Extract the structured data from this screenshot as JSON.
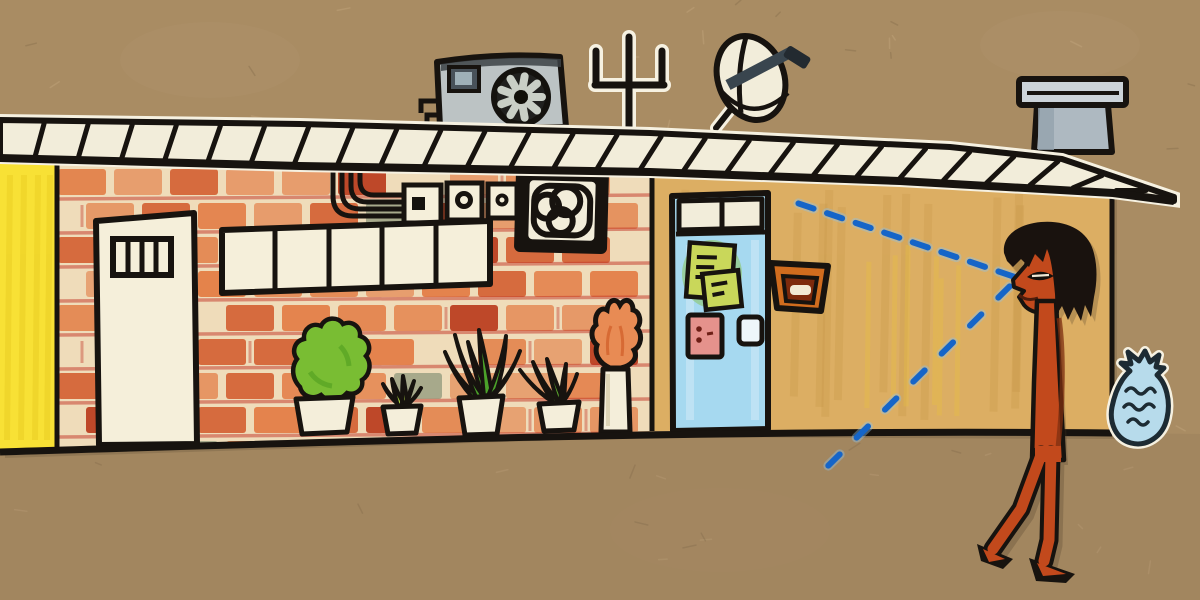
{
  "meta": {
    "title": "Hand-drawn building illustration on kraft paper",
    "medium": "marker and crayon collage"
  },
  "palette": {
    "kraft": "#a98c63",
    "kraftDark": "#856c4e",
    "outline": "#17130f",
    "roofWhite": "#f2edda",
    "stickerWhite": "#f6f1e1",
    "shadow": "#4a3a26",
    "yellowWall": "#f8e135",
    "yellowStreak": "#e6c81e",
    "brickBase": "#efdcba",
    "brickOrange": "#e06a2e",
    "brickDeep": "#cf4f1f",
    "brickRed": "#b8371a",
    "brickGray": "#9aa083",
    "mortarRed": "#c23527",
    "doorWhite": "#f5efda",
    "acGray": "#bcc3c4",
    "acDark": "#3c4245",
    "fanBlade": "#c9cfc6",
    "chimneyGray": "#aeb9c1",
    "chimneyCap": "#ccd3d8",
    "dishBand": "#39454e",
    "tanWall": "#dcae63",
    "tanStreak": "#c49343",
    "tanYellow": "#e6bd45",
    "doorBlue": "#a6d9f0",
    "blueStreak": "#d6ecf8",
    "noteGreen": "#c9d75a",
    "noteGlow": "#86c03c",
    "switchPink": "#e5928c",
    "switchDots": "#6e1f16",
    "mailOrange": "#d06c1e",
    "mailInner": "#7e2a0c",
    "potWhite": "#f4eeda",
    "bushGreen": "#79bd33",
    "bushDark": "#55a322",
    "spikyGreen": "#4ba32a",
    "spikyLight": "#a5cc3d",
    "spikyMid": "#5eae2f",
    "flameOrange": "#e88b54",
    "flameDark": "#d2622c",
    "skin": "#c2491c",
    "skinDark": "#7e2f10",
    "hairBlack": "#19120e",
    "bagBlue": "#b7dbeb",
    "bagLine": "#1d2b33",
    "dashBlue": "#1565c8",
    "dashHalo": "#8fc2e8"
  },
  "scene": {
    "background": {
      "label": "kraft paper",
      "speckles": 70
    },
    "roof": {
      "label": "white roof band with hatched shingles",
      "hatch_count": 26
    },
    "rooftop_equipment": {
      "ac_unit": {
        "label": "air conditioner with round fan",
        "blades": 9
      },
      "antenna": {
        "label": "three-prong tv antenna"
      },
      "satellite_dish": {
        "label": "tilted satellite dish"
      },
      "chimney": {
        "label": "grey chimney vent"
      }
    },
    "walls": {
      "yellow_section": {
        "label": "yellow wall strip (far left)"
      },
      "brick_section": {
        "label": "orange crayon brick wall",
        "rows": 9,
        "left": 58,
        "right": 650,
        "top": 169,
        "row_height": 34,
        "brick_width": 48,
        "gap": 8
      },
      "tan_section": {
        "label": "tan stucco wall"
      }
    },
    "openings": {
      "white_door": {
        "label": "white door with small barred window",
        "bars": 3
      },
      "window_band": {
        "label": "horizontal strip window",
        "panes": 5
      },
      "blue_door": {
        "label": "blue door with two-pane transom",
        "sticky_notes": 2
      }
    },
    "fixtures": {
      "conduit": {
        "label": "curved conduit pipes",
        "lines": 4
      },
      "electrical_boxes": {
        "label": "meter boxes",
        "count": 3
      },
      "fan_vent": {
        "label": "black wall fan vent"
      },
      "mailbox": {
        "label": "orange wall mailbox with slot"
      }
    },
    "plants": [
      {
        "type": "round scalloped bush",
        "pot": "white pot"
      },
      {
        "type": "small spiky plant",
        "pot": "white pot"
      },
      {
        "type": "tall arching spiky plant",
        "pot": "white pot"
      },
      {
        "type": "leaning spiky plant",
        "pot": "white pot"
      },
      {
        "type": "orange flame plant",
        "pot": "white pedestal column"
      }
    ],
    "person": {
      "label": "thin walking figure with shaggy black hair",
      "facing": "left"
    },
    "sight_lines": {
      "upper": {
        "from": [
          1006,
          274
        ],
        "to": [
          806,
          206
        ],
        "dashes": 8
      },
      "lower": {
        "from": [
          1004,
          292
        ],
        "to": [
          834,
          460
        ],
        "dashes": 7
      }
    },
    "trash_bag": {
      "label": "tied garbage bag at wall corner",
      "squiggles": 3
    }
  }
}
